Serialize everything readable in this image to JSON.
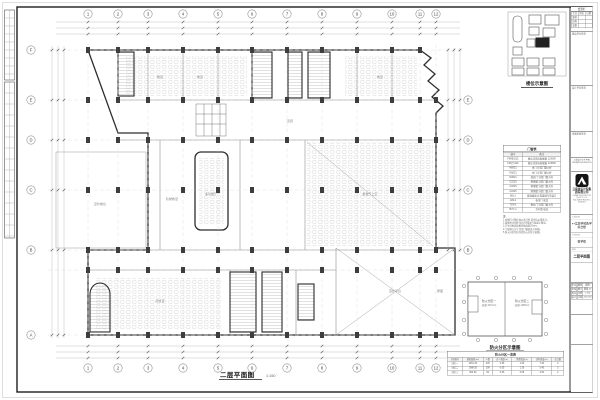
{
  "sheet": {
    "plan_title": "二层平面图",
    "plan_scale": "1:150",
    "key_plan_title": "楼位示意图",
    "fire_plan_title": "防火分区示意图"
  },
  "axes": {
    "top": [
      "1",
      "2",
      "3",
      "4",
      "5",
      "6",
      "7",
      "8",
      "9",
      "10",
      "11",
      "12"
    ],
    "bottom": [
      "1",
      "2",
      "3",
      "4",
      "5",
      "6",
      "7",
      "8",
      "9",
      "10",
      "11",
      "12"
    ],
    "left": [
      "F",
      "E",
      "D",
      "C",
      "B",
      "A"
    ],
    "right": [
      "E",
      "D",
      "C",
      "B"
    ]
  },
  "plan": {
    "rooms": [
      "教室",
      "教室",
      "教室",
      "阶梯教室",
      "多功能厅",
      "报告厅上空",
      "室外平台",
      "屋面",
      "室外看台",
      "阅览室",
      "走廊"
    ]
  },
  "fire_plan": {
    "zone1": "防火分区一",
    "zone1_area": "(面积:2451m²)",
    "zone2": "防火分区二",
    "zone2_area": "(面积:1989m²)"
  },
  "legend": {
    "title": "门窗表",
    "headers": [
      "编号",
      "备注"
    ],
    "rows": [
      [
        "FM甲1021",
        "做法详见标准图集 12J609"
      ],
      [
        "FM乙1221",
        "做法详见标准图集 12J609"
      ],
      [
        "M0921",
        "木门 详见门窗大样"
      ],
      [
        "M1021",
        "木门 详见门窗大样"
      ],
      [
        "M1521",
        "双扇门 详见门窗大样"
      ],
      [
        "C1515",
        "塑钢窗 详见门窗大样"
      ],
      [
        "C1815",
        "塑钢窗 详见门窗大样"
      ],
      [
        "C2415",
        "塑钢窗 详见门窗大样"
      ],
      [
        "MQ-1",
        "玻璃幕墙 详见幕墙专项设计"
      ],
      [
        "JLM-1",
        "卷帘门 成品"
      ],
      [
        "TLM-1",
        "推拉门 详见门窗大样"
      ],
      [
        "BYC-1",
        "百叶窗 成品"
      ]
    ]
  },
  "notes": {
    "label": "注:",
    "items": [
      "1.本图尺寸除标高以米计外,其余均以毫米计。",
      "2.墙体除注明外均为200厚加气混凝土砌块。",
      "3.卫生间地面较相邻地面低20mm。",
      "4.门窗洞口尺寸详见门窗表及大样图。",
      "5.防火分区划分详见防火分区示意图。"
    ]
  },
  "fire_table": {
    "title": "防火分区一览表",
    "headers": [
      "分区编号",
      "建筑面积(m²)",
      "人数",
      "百人宽度(m)",
      "需要宽度(m)",
      "实际宽度(m)",
      "出口数"
    ],
    "rows": [
      [
        "分区一",
        "2451.30",
        "245",
        "0.65",
        "1.60",
        "7.20",
        "4"
      ],
      [
        "分区二",
        "1988.50",
        "199",
        "0.65",
        "1.30",
        "5.40",
        "3"
      ],
      [
        "分区三",
        "902.60",
        "90",
        "0.65",
        "0.59",
        "3.60",
        "2"
      ]
    ]
  },
  "title_block": {
    "sign_title": "会签栏",
    "sign_headers": [
      "专业",
      "姓名",
      "日期"
    ],
    "sign_rows": [
      [
        "建筑",
        "",
        ""
      ],
      [
        "结构",
        "",
        ""
      ],
      [
        "设备",
        "",
        ""
      ]
    ],
    "sections": [
      "建设单位签章",
      "设计单位签章",
      "审图机构签章"
    ],
    "cert_lines": [
      "工程设计证书 甲级",
      "证书编号 A153001234"
    ],
    "company": "云南省设计院集团有限公司",
    "company_en": "YUNNAN DESIGN INSTITUTE GROUP CO.,LTD.",
    "company_addr": "地址:昆明市 电话:0871-63636363",
    "fields": [
      {
        "label": "工程名称",
        "value": "××实验学校教学综合楼"
      },
      {
        "label": "子项名称",
        "value": "教学楼"
      },
      {
        "label": "图名",
        "value": "二层平面图"
      }
    ],
    "grid_rows": [
      [
        "审定",
        "",
        "图别",
        "建施"
      ],
      [
        "审核",
        "",
        "图号",
        "建施-05"
      ],
      [
        "校对",
        "",
        "比例",
        "1:150"
      ],
      [
        "设计",
        "",
        "日期",
        "2023.06"
      ]
    ]
  }
}
